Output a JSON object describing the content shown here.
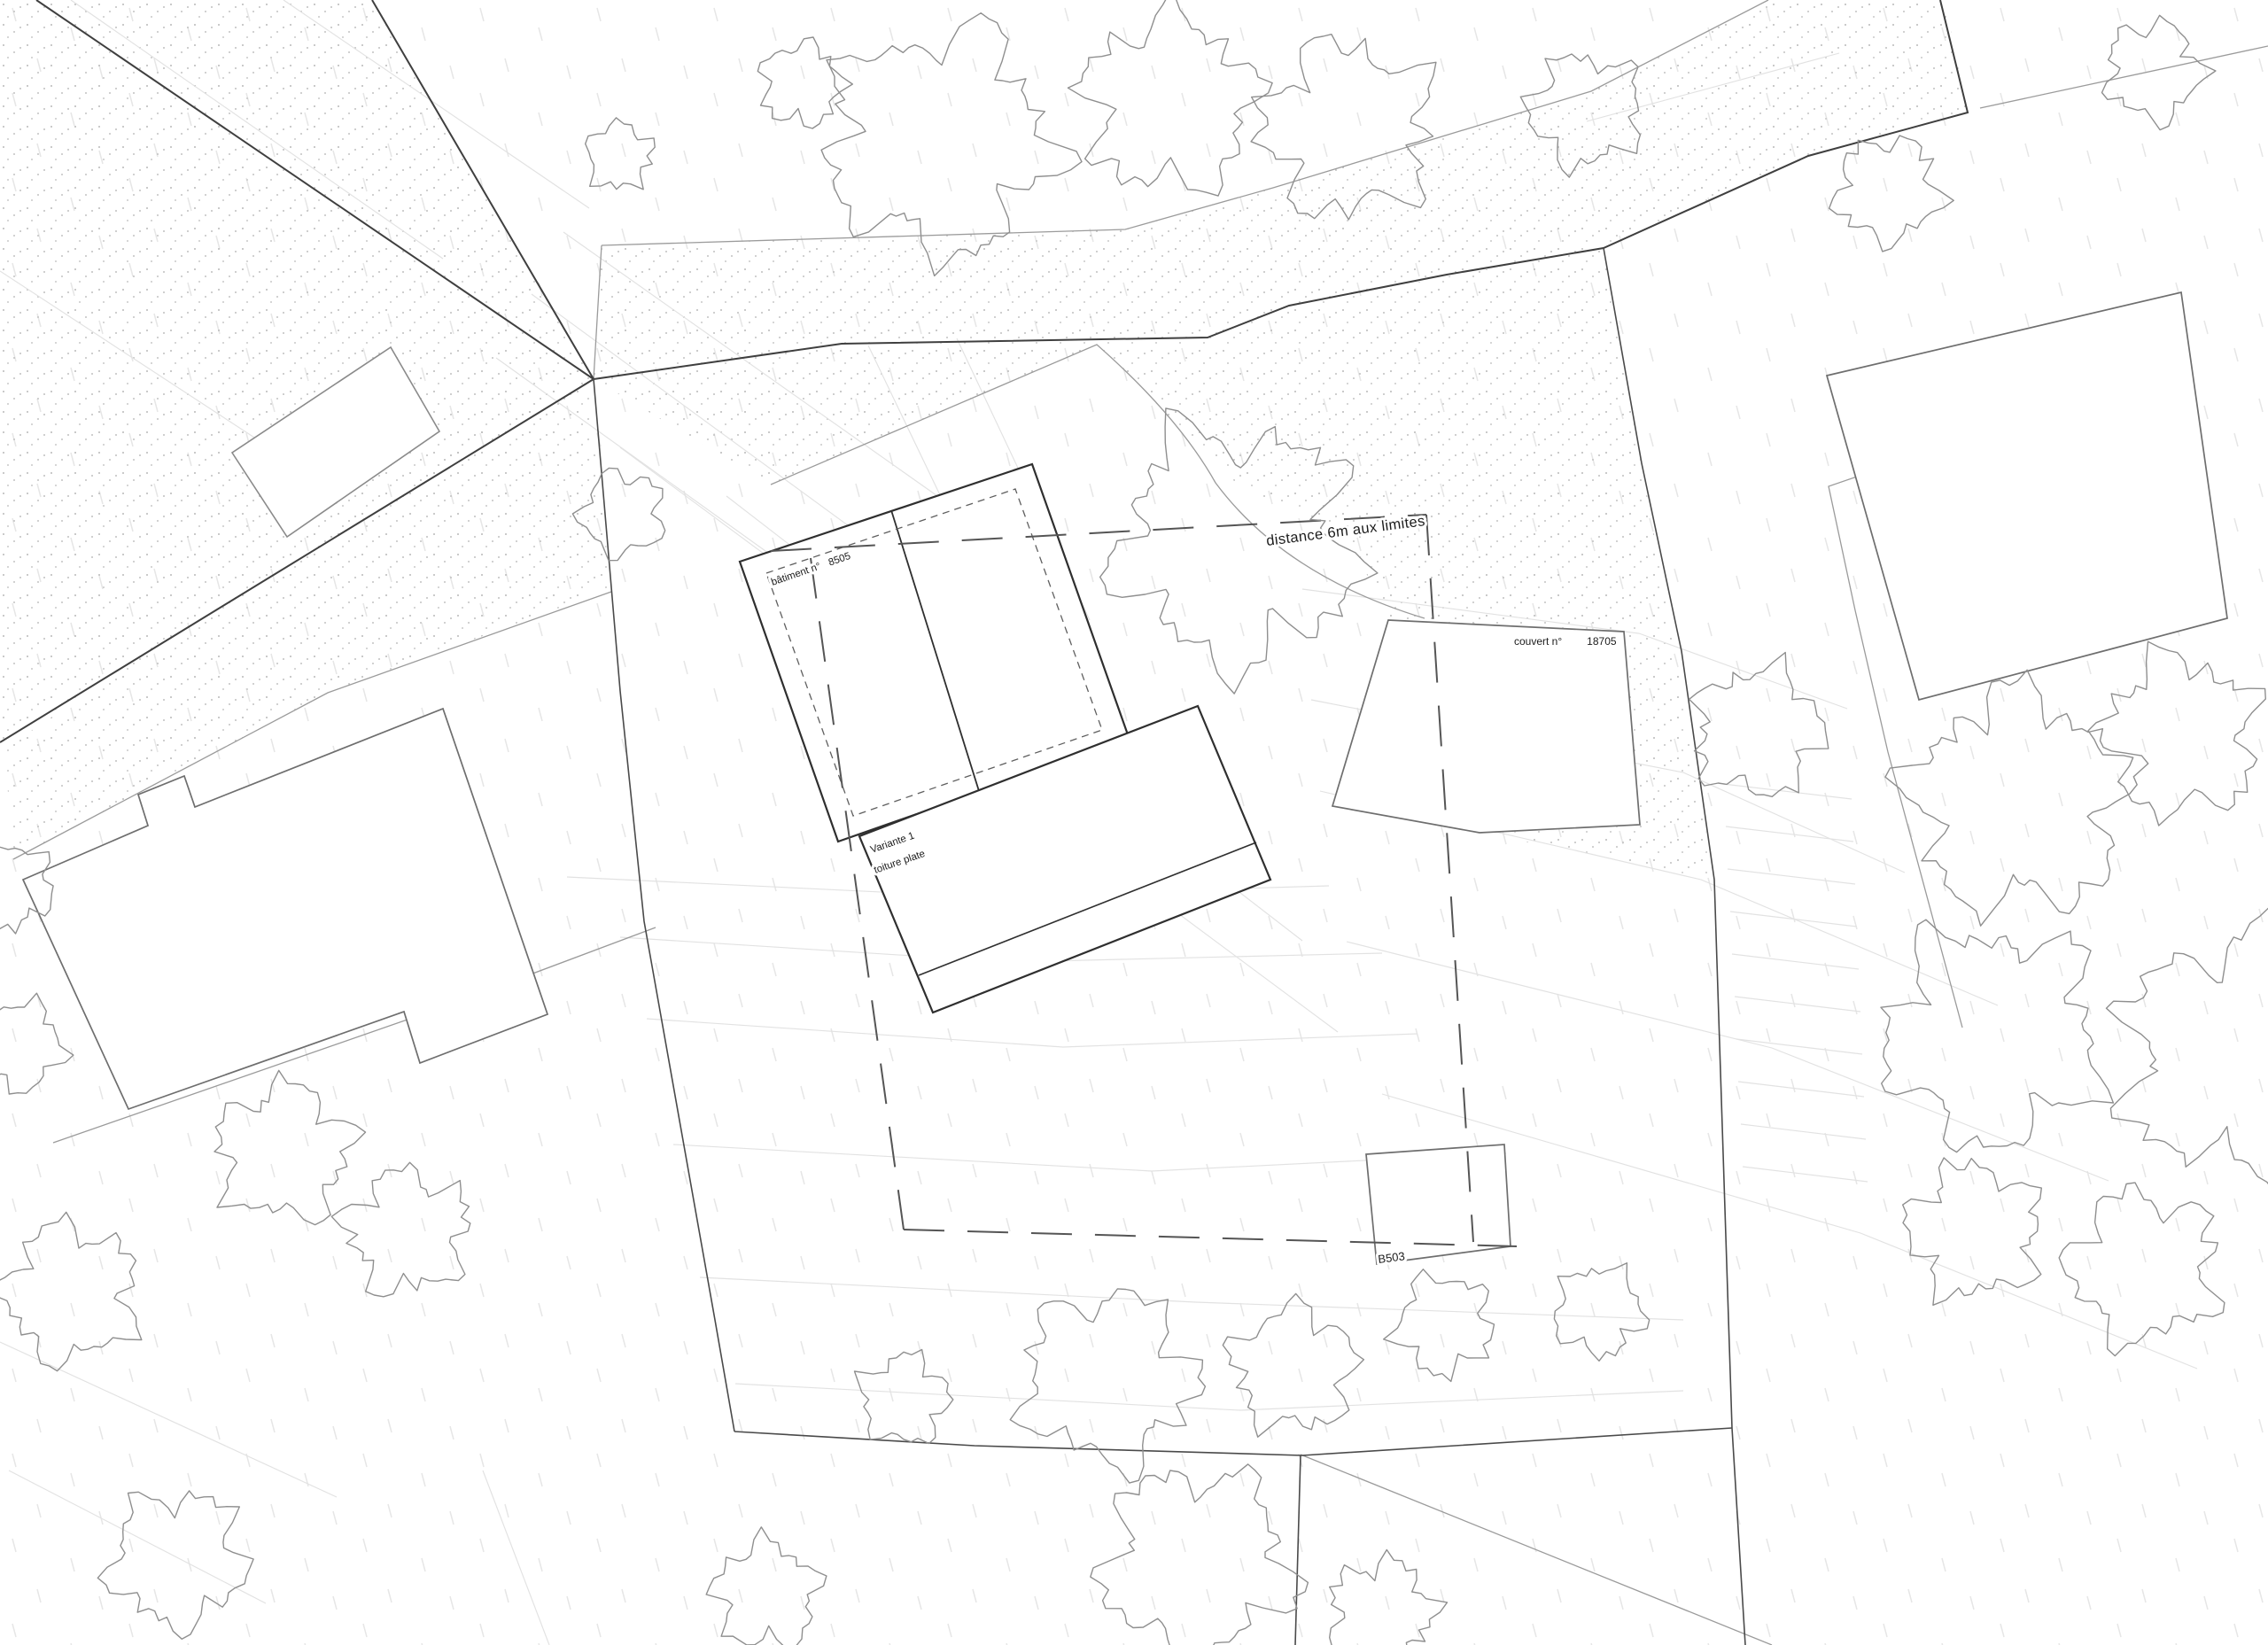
{
  "plan": {
    "labels": {
      "distance_setback": "distance 6m aux limites",
      "building_name": "bâtiment n°",
      "building_number": "8505",
      "couvert_name": "couvert n°",
      "couvert_number": "18705",
      "variant_line1": "Variante 1",
      "variant_line2": "toiture plate",
      "annex_number": "B503"
    },
    "colors": {
      "paper": "#ffffff",
      "parcel_line": "#3f3f3f",
      "building_line": "#2f2f2f",
      "tree_line": "#8f8f8f",
      "contour_line": "#e2e2e2",
      "stipple_dot": "#bcbcbc",
      "text": "#1c1c1c"
    }
  }
}
